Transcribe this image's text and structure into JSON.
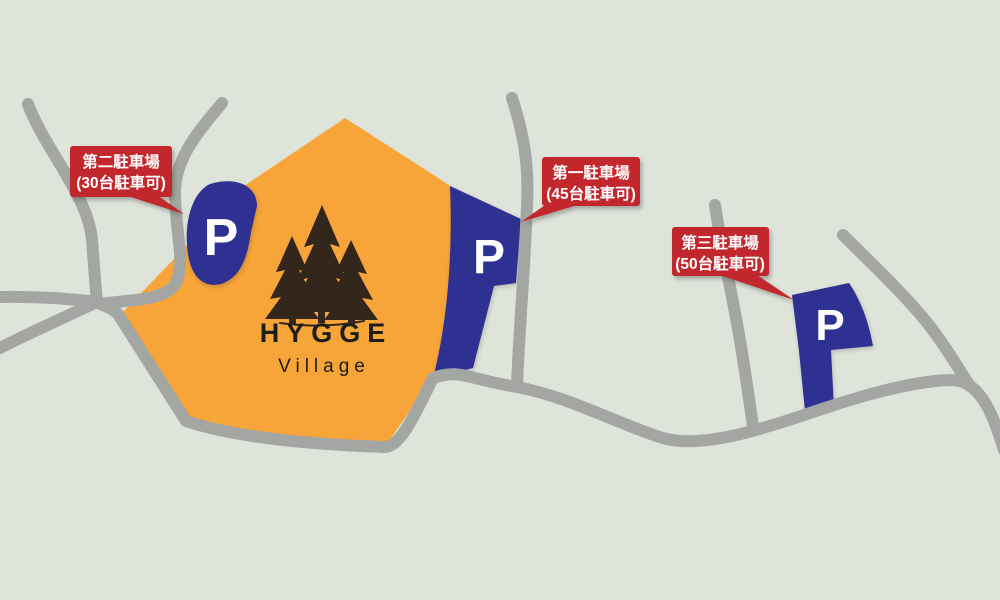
{
  "map": {
    "background_color": "#dfe4da",
    "road_color": "#a4a6a3",
    "village_area_color": "#f7a439",
    "parking_color": "#2e3192",
    "parking_symbol_color": "#ffffff",
    "label_color": "#c1272d",
    "label_text_color": "#ffffff",
    "logo": {
      "title": "HYGGE",
      "subtitle": "Village",
      "tree_color": "#33261a",
      "text_color": "#1d1d1b"
    },
    "parkings": [
      {
        "name": "第二駐車場",
        "capacity": "(30台駐車可)",
        "symbol": "P"
      },
      {
        "name": "第一駐車場",
        "capacity": "(45台駐車可)",
        "symbol": "P"
      },
      {
        "name": "第三駐車場",
        "capacity": "(50台駐車可)",
        "symbol": "P"
      }
    ]
  }
}
